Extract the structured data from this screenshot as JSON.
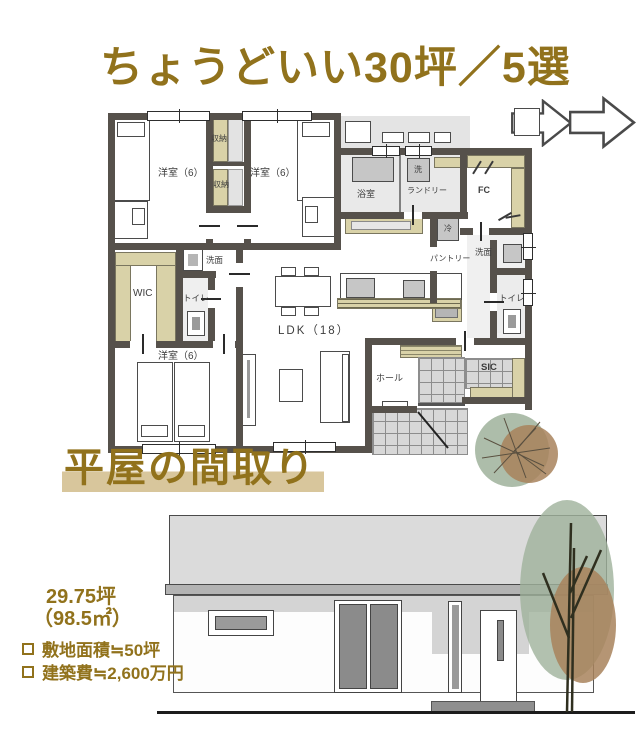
{
  "title": "ちょうどいい30坪／5選",
  "plan_caption": "平屋の間取り",
  "arrows": {
    "icon": "right-arrow",
    "count": 2
  },
  "plan": {
    "labels": {
      "bedroom1": "洋室（6）",
      "bedroom2": "洋室（6）",
      "bedroom3": "洋室（6）",
      "closet_top": "収納",
      "closet_bottom": "収納",
      "bath": "浴室",
      "laundry": "ランドリー",
      "washer": "洗",
      "family_closet": "FC",
      "fridge": "冷",
      "pantry": "パントリー",
      "washroom_left": "洗面",
      "washroom_right": "洗面",
      "toilet_left": "トイレ",
      "toilet_right": "トイレ",
      "wic": "WIC",
      "ldk": "LDK（18）",
      "hall": "ホール",
      "sic": "SIC"
    }
  },
  "specs": {
    "floor_area_tsubo": "29.75坪",
    "floor_area_sqm": "（98.5㎡）",
    "items": [
      {
        "label": "敷地面積≒50坪"
      },
      {
        "label": "建築費≒2,600万円"
      }
    ]
  },
  "colors": {
    "gold": "#91721c",
    "caption_highlight": "#d8c69c",
    "wall": "#56514b",
    "closet_beige": "#d9d2a8",
    "room_gray": "#e9e9e9",
    "roof_gray": "#dbdbdb",
    "tree_green": "#9fb29b",
    "tree_brown": "#a8825c"
  }
}
